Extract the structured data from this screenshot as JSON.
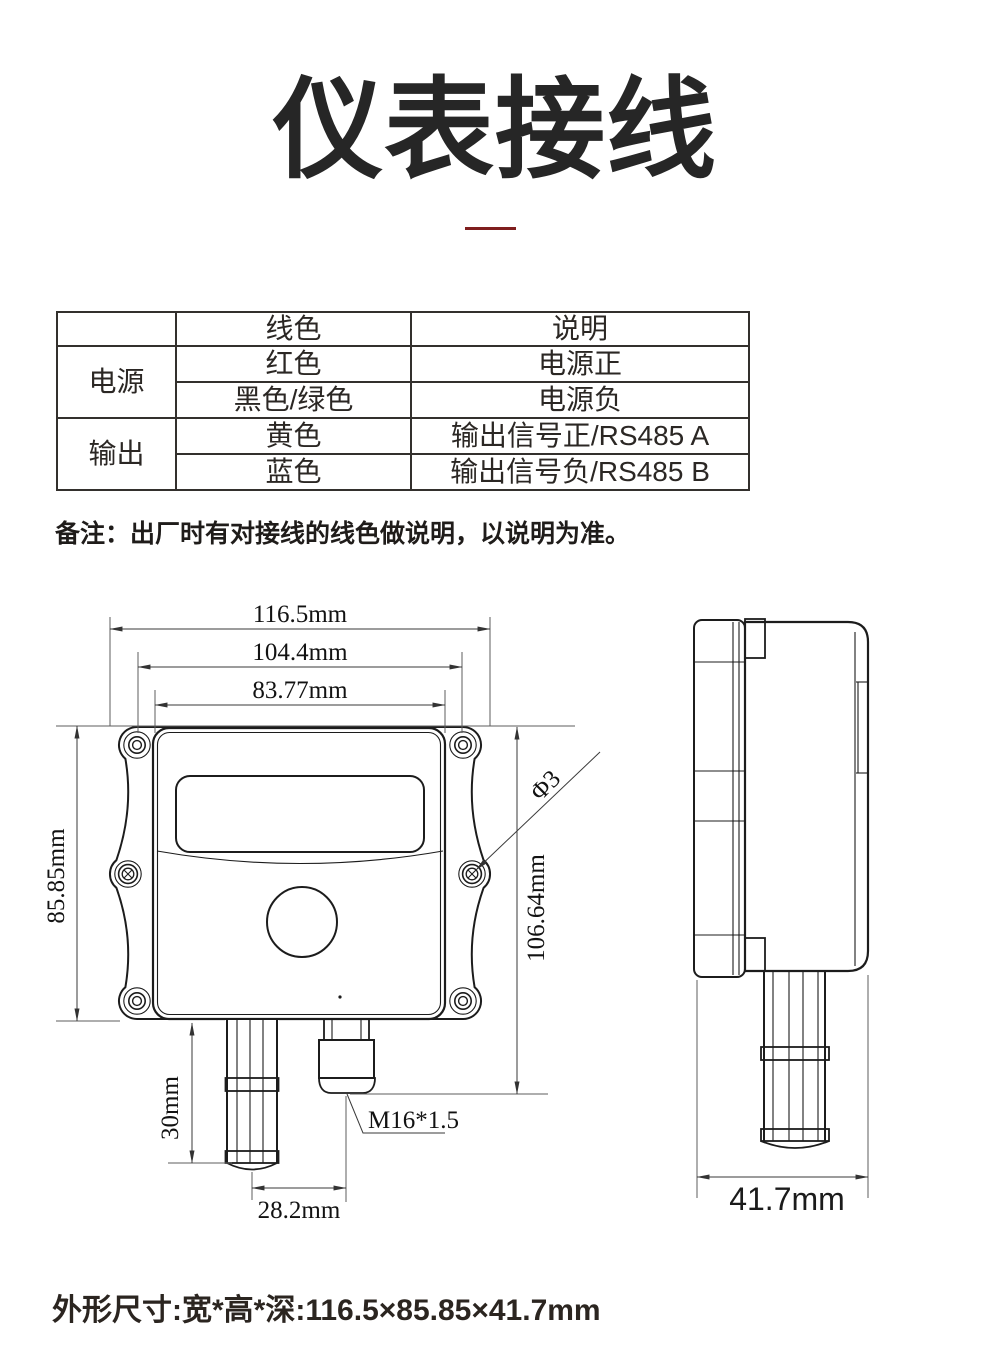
{
  "title": "仪表接线",
  "accent_color": "#7f1e1e",
  "wiring_table": {
    "headers": [
      "",
      "线色",
      "说明"
    ],
    "groups": [
      {
        "label": "电源",
        "rows": [
          {
            "color": "红色",
            "desc": "电源正"
          },
          {
            "color": "黑色/绿色",
            "desc": "电源负"
          }
        ]
      },
      {
        "label": "输出",
        "rows": [
          {
            "color": "黄色",
            "desc": "输出信号正/RS485 A"
          },
          {
            "color": "蓝色",
            "desc": "输出信号负/RS485 B"
          }
        ]
      }
    ]
  },
  "note": "备注：出厂时有对接线的线色做说明，以说明为准。",
  "drawing": {
    "front": {
      "width_outer": "116.5mm",
      "width_mount": "104.4mm",
      "width_inner": "83.77mm",
      "height_body": "85.85mm",
      "height_total": "106.64mm",
      "probe_length": "30mm",
      "probe_offset": "28.2mm",
      "hole_dia": "Φ3",
      "gland_thread": "M16*1.5"
    },
    "side": {
      "depth": "41.7mm"
    }
  },
  "footer": "外形尺寸:宽*高*深:116.5×85.85×41.7mm"
}
